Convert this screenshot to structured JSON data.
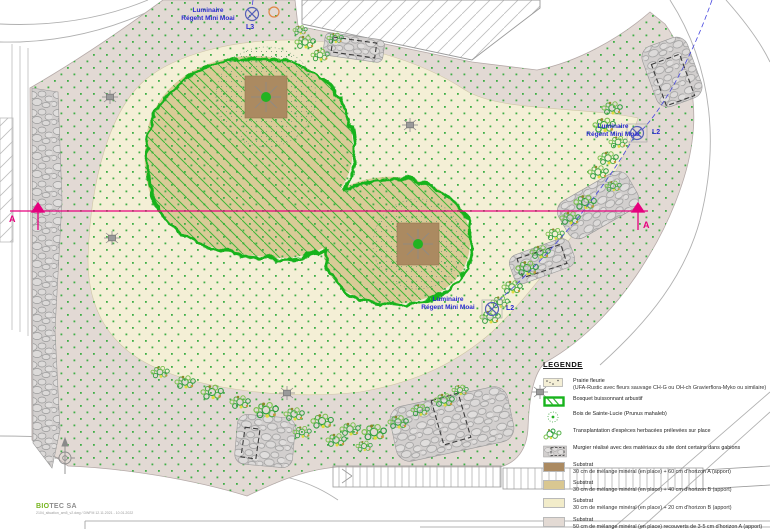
{
  "plan": {
    "section_label_left": "A",
    "section_label_right": "A",
    "luminaires": [
      {
        "name_line1": "Luminaire",
        "name_line2": "Régent Mini Moai",
        "code": "L3"
      },
      {
        "name_line1": "Luminaire",
        "name_line2": "Régent Mini Moai",
        "code": "L2"
      },
      {
        "name_line1": "Luminaire",
        "name_line2": "Régent Mini Moai",
        "code": "L2"
      }
    ]
  },
  "legend": {
    "title": "LEGENDE",
    "items": [
      {
        "icon": "prairie-swatch",
        "label": "Prairie fleurie",
        "detail": "(UFA-Rustic avec fleurs sauvage CH-G ou OH-ch Gravierflora-Myko ou similaire)"
      },
      {
        "icon": "bosquet-swatch",
        "label": "Bosquet buissonnant arbustif",
        "detail": ""
      },
      {
        "icon": "tree-icon",
        "label": "Bois de Sainte-Lucie (Prunus mahaleb)",
        "detail": ""
      },
      {
        "icon": "transplant-icon",
        "label": "Transplantation d'espèces herbacées prélevées sur place",
        "detail": ""
      },
      {
        "icon": "murgier-icon",
        "label": "Murgier réalisé avec des matériaux du site dont certains dans gabions",
        "detail": ""
      },
      {
        "icon": "substrat-brown-swatch",
        "label": "Substrat",
        "detail": "30 cm de mélange minéral (en place) + 60 cm d'horizon A (apport)"
      },
      {
        "icon": "substrat-tan-swatch",
        "label": "Substrat",
        "detail": "30 cm de mélange minéral (en place) + 40 cm d'horizon B (apport)"
      },
      {
        "icon": "substrat-cream-swatch",
        "label": "Substrat",
        "detail": "30 cm de mélange minéral (en place) + 20 cm d'horizon B (apport)"
      },
      {
        "icon": "substrat-gray-swatch",
        "label": "Substrat",
        "detail": "50 cm de mélange minéral (en place) recouverts de 3-5 cm d'horizon A (apport)"
      }
    ]
  },
  "footer": {
    "company_bold": "BIO",
    "company_rest": "TEC SA",
    "file_note": "2104_situation_am5_v2.dwg / DWFM 12.11.2021 - 10.01.2022"
  },
  "colors": {
    "site_mineral": "#e2d9d4",
    "prairie": "#f4efd6",
    "bosquet_fill": "#d9cb97",
    "bosquet_line": "#17b31c",
    "substrat_brown": "#ab8a61",
    "section_magenta": "#e6007e",
    "luminaire_blue": "#2a2ad0",
    "logo_green": "#76b41e"
  }
}
